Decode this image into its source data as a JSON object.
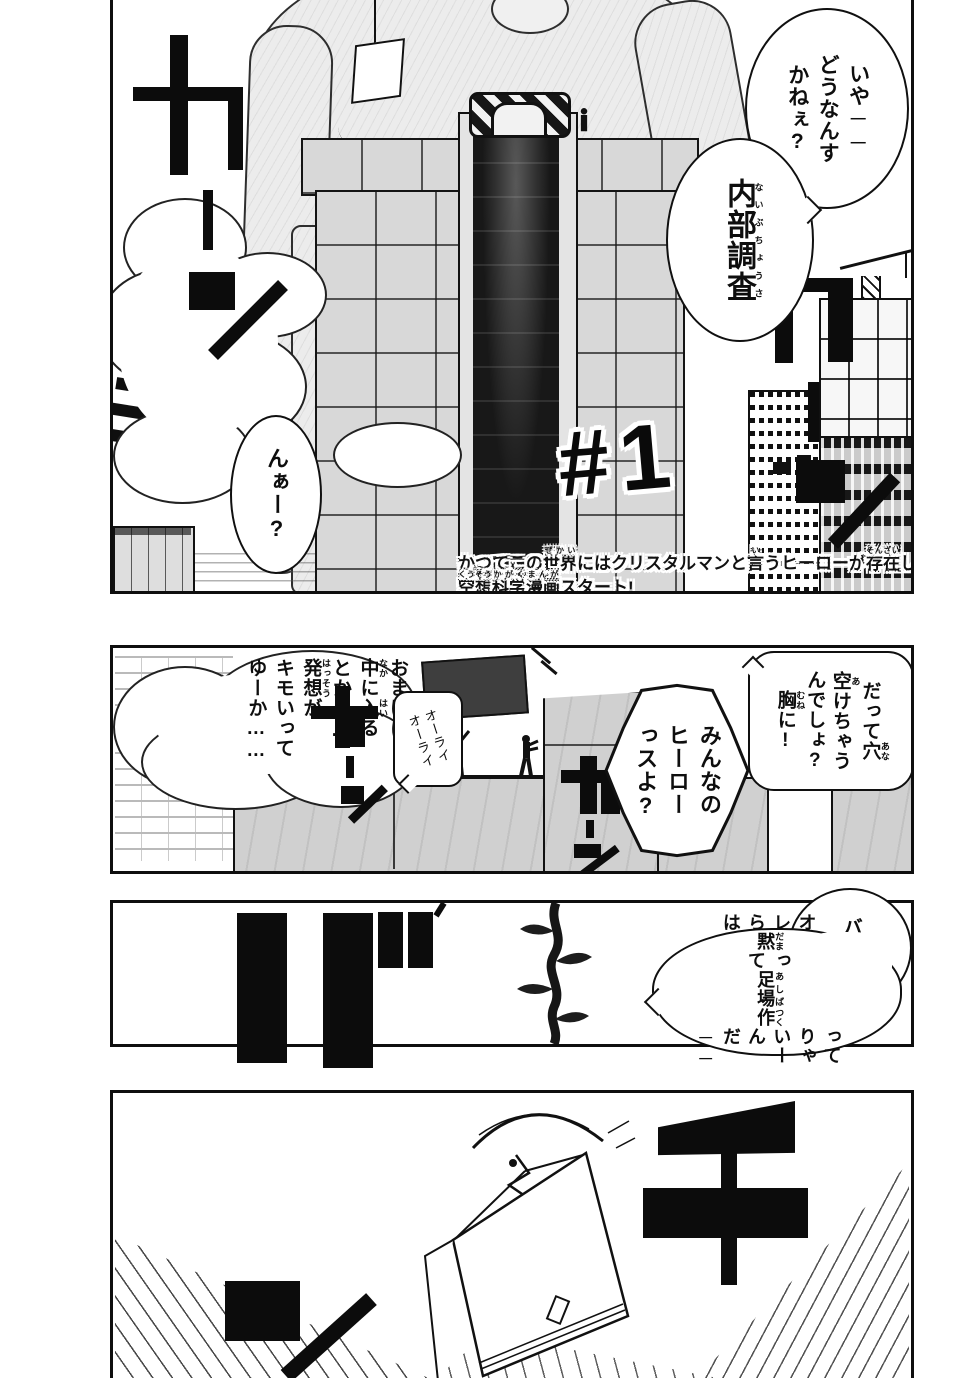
{
  "colors": {
    "ink": "#111111",
    "paper": "#ffffff",
    "tone_light": "#ececec",
    "tone_mid": "#d6d6d6",
    "tone_dark": "#1c1c1c"
  },
  "title": {
    "chapter_number": "#1"
  },
  "caption": {
    "line1": [
      {
        "t": "かつてこの"
      },
      {
        "t": "世界",
        "r": "せかい"
      },
      {
        "t": "にはクリスタルマンと"
      },
      {
        "t": "言",
        "r": "い"
      },
      {
        "t": "うヒーローが"
      },
      {
        "t": "存在",
        "r": "そんざい"
      },
      {
        "t": "した。"
      }
    ],
    "line2": [
      {
        "t": "空想",
        "r": "くうそう"
      },
      {
        "t": "科学",
        "r": "かがく"
      },
      {
        "t": "漫画",
        "r": "まんが"
      },
      {
        "t": "スタート!"
      }
    ]
  },
  "panel1": {
    "sfx_left": "カーン",
    "sfx_right": "カーン",
    "bubbles": {
      "iya": {
        "segments": [
          {
            "t": "いや──"
          },
          {
            "br": true
          },
          {
            "t": "どうなんす"
          },
          {
            "br": true
          },
          {
            "t": "かねぇ?"
          }
        ]
      },
      "naibu": {
        "segments": [
          {
            "t": "内部調査",
            "r": "ないぶちょうさ"
          }
        ]
      },
      "naa": {
        "segments": [
          {
            "t": "んぁー?"
          }
        ]
      }
    }
  },
  "panel2": {
    "sfx_left": "カーン",
    "sfx_right": "カーン",
    "bubbles": {
      "omake": {
        "segments": [
          {
            "t": "おまけに"
          },
          {
            "br": true
          },
          {
            "t": "中",
            "r": "なか"
          },
          {
            "t": "に"
          },
          {
            "t": "入",
            "r": "はい"
          },
          {
            "t": "る"
          },
          {
            "br": true
          },
          {
            "t": "とか……"
          },
          {
            "br": true
          },
          {
            "t": "発想",
            "r": "はっそう"
          },
          {
            "t": "が"
          },
          {
            "br": true
          },
          {
            "t": "キモいって"
          },
          {
            "br": true
          },
          {
            "t": "ゆーか……"
          }
        ]
      },
      "orai": {
        "segments": [
          {
            "t": "オーライ"
          },
          {
            "br": true
          },
          {
            "t": "オーライ"
          }
        ]
      },
      "minna": {
        "segments": [
          {
            "t": "みんなの"
          },
          {
            "br": true
          },
          {
            "t": "ヒーロー"
          },
          {
            "br": true
          },
          {
            "t": "っスよ?"
          }
        ]
      },
      "datte": {
        "segments": [
          {
            "t": "だって"
          },
          {
            "t": "穴",
            "r": "あな"
          },
          {
            "br": true
          },
          {
            "t": "空",
            "r": "あ"
          },
          {
            "t": "けちゃう"
          },
          {
            "br": true
          },
          {
            "t": "んでしょ?"
          },
          {
            "br": true
          },
          {
            "t": "胸",
            "r": "むね"
          },
          {
            "t": "に!"
          }
        ]
      }
    }
  },
  "panel3": {
    "sfx": "ガ",
    "bubbles": {
      "baka": {
        "segments": [
          {
            "t": "バーカ"
          }
        ]
      },
      "ore": {
        "segments": [
          {
            "t": "オレらは"
          },
          {
            "br": true
          },
          {
            "t": "黙",
            "r": "だま"
          },
          {
            "t": "って"
          },
          {
            "br": true
          },
          {
            "t": "足場",
            "r": "あしば"
          },
          {
            "t": "作",
            "r": "つく"
          },
          {
            "t": "って"
          },
          {
            "br": true
          },
          {
            "t": "りゃいーん"
          },
          {
            "br": true
          },
          {
            "t": "だ──"
          }
        ]
      }
    }
  },
  "panel4": {
    "sfx": "チーン"
  },
  "sound_effects": [
    {
      "location": "panel1-left",
      "reading": "カーン"
    },
    {
      "location": "panel1-right",
      "reading": "カーン"
    },
    {
      "location": "panel2-left",
      "reading": "カーン"
    },
    {
      "location": "panel2-right",
      "reading": "カーン"
    },
    {
      "location": "panel3",
      "reading": "ガ"
    },
    {
      "location": "panel4",
      "reading": "チーン"
    }
  ]
}
